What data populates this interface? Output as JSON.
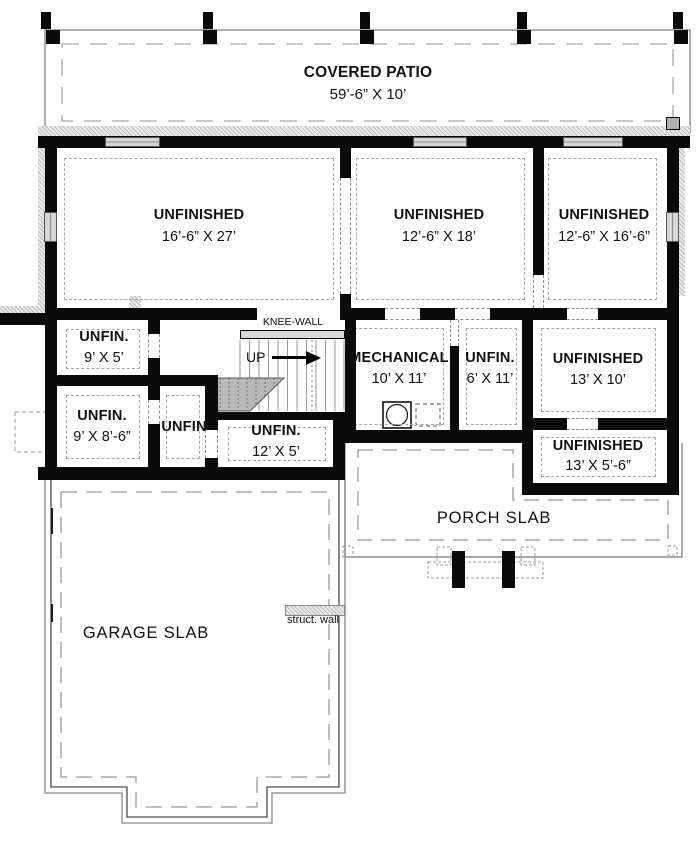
{
  "title": "Basement floor plan",
  "colors": {
    "wall": "#0a0a0a",
    "dashed_line": "#8f8f8f",
    "hatch": "#b9b9b9",
    "window_fill": "#d6d6d6",
    "stair_shade": "#b8b8b8",
    "knee_wall_fill": "#d8d8d8",
    "background": "#ffffff"
  },
  "areas": {
    "covered_patio": {
      "name": "COVERED PATIO",
      "dims": "59’-6” X 10’"
    },
    "unfinished_a": {
      "name": "UNFINISHED",
      "dims": "16’-6” X 27’"
    },
    "unfinished_b": {
      "name": "UNFINISHED",
      "dims": "12’-6” X 18’"
    },
    "unfinished_c": {
      "name": "UNFINISHED",
      "dims": "12’-6” X 16’-6”"
    },
    "unfin_9x5": {
      "name": "UNFIN.",
      "dims": "9’ X 5’"
    },
    "unfin_9x86": {
      "name": "UNFIN.",
      "dims": "9’ X 8’-6”"
    },
    "unfin_small": {
      "name": "UNFIN",
      "dims": ""
    },
    "unfin_12x5": {
      "name": "UNFIN.",
      "dims": "12’ X 5’"
    },
    "mechanical": {
      "name": "MECHANICAL",
      "dims": "10’ X 11’"
    },
    "unfin_6x11": {
      "name": "UNFIN.",
      "dims": "6’ X 11’"
    },
    "unfinished_13x10": {
      "name": "UNFINISHED",
      "dims": "13’ X 10’"
    },
    "unfinished_13x56": {
      "name": "UNFINISHED",
      "dims": "13’ X 5’-6”"
    },
    "porch_slab": {
      "name": "PORCH SLAB",
      "dims": ""
    },
    "garage_slab": {
      "name": "GARAGE SLAB",
      "dims": ""
    }
  },
  "annotations": {
    "knee_wall": "KNEE-WALL",
    "up": "UP",
    "struct_wall": "struct. wall"
  }
}
